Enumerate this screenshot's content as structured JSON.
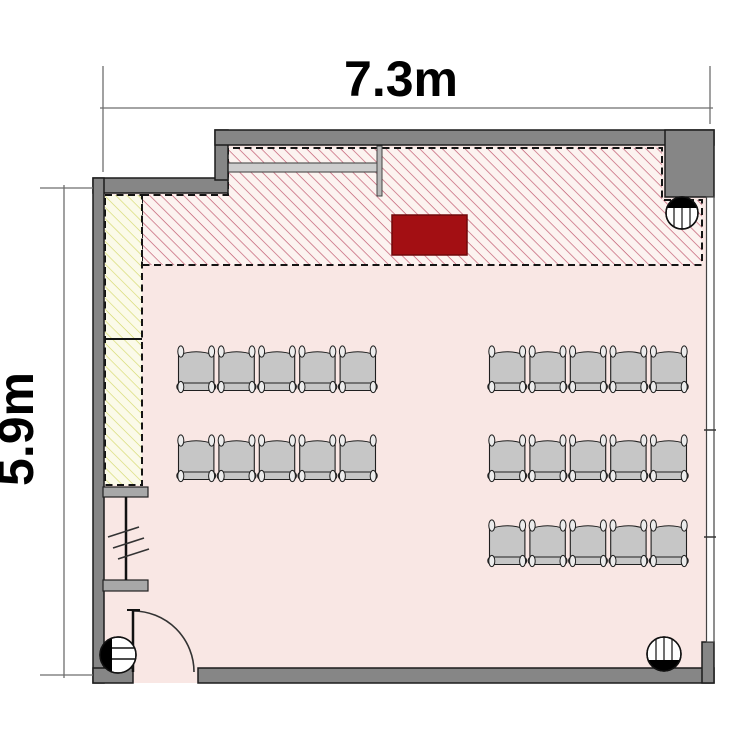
{
  "page": {
    "background": "#ffffff",
    "kind": "classroom floor plan"
  },
  "dimensions": {
    "width_label": "7.3m",
    "height_label": "5.9m"
  },
  "colors": {
    "floor": "#f9e7e4",
    "wall_fill": "#868686",
    "wall_outline": "#1c1c1c",
    "hatch_zone_bg": "#fcf3f0",
    "hatch_stripe": "#c25d72",
    "closet_bg": "#fbfae9",
    "closet_stripe": "#d5d96c",
    "dashed_outline": "#141414",
    "desk_fill": "#a30f13",
    "desk_outline": "#70090b",
    "board_fill": "#cdcdcd",
    "chair_fill": "#c6c6c6",
    "chair_outline": "#1f1f1f",
    "chair_loop_fill": "#ececec",
    "dimension_line": "#6e6e6e",
    "text": "#000000"
  },
  "plan": {
    "room": {
      "width": "7.3m",
      "height": "5.9m"
    },
    "chair_groups": [
      {
        "id": "left-block",
        "x": 176,
        "seat_width": 40.4,
        "seats_per_row": 5,
        "rows_y": [
          345,
          434
        ]
      },
      {
        "id": "right-block",
        "x": 487,
        "seat_width": 40.4,
        "seats_per_row": 5,
        "rows_y": [
          345,
          434,
          519
        ]
      }
    ],
    "fixtures": [
      {
        "id": "column-top-right",
        "cx": 682,
        "cy": 213,
        "r": 16,
        "cap": "top",
        "lines": "v"
      },
      {
        "id": "column-bottom-left",
        "cx": 118,
        "cy": 655,
        "r": 18,
        "cap": "left",
        "lines": "h"
      },
      {
        "id": "column-bottom-right",
        "cx": 664,
        "cy": 654,
        "r": 17,
        "cap": "bottom",
        "lines": "v"
      }
    ]
  }
}
